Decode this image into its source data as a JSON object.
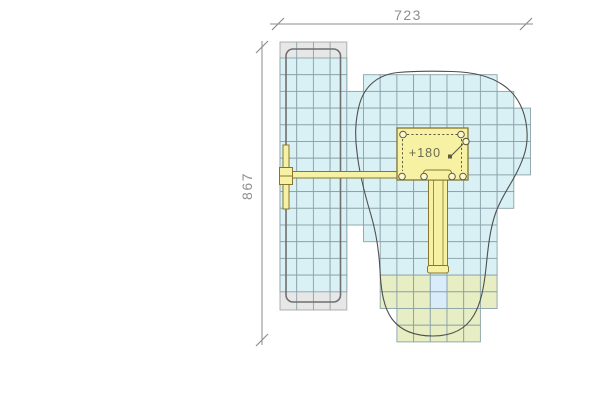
{
  "drawing": {
    "background": "#ffffff",
    "colors": {
      "tile_cyan": "#d9f1f4",
      "tile_green": "#e7eec3",
      "tile_landing": "#d9ecf9",
      "tile_stroke": "#8aa2a9",
      "mat_gray": "#e7e7e7",
      "mat_stroke": "#a8a8a8",
      "mat_inner_outline": "#6f6f6f",
      "zone_outline": "#4f4f4f",
      "equip_fill": "#f7f1a3",
      "equip_fill_light": "#fbf7cf",
      "equip_stroke": "#857634",
      "detail_stroke": "#5c5c44",
      "dim_color": "#8e8e8e",
      "label_color": "#6a6a52"
    },
    "grid": {
      "origin_x": 280,
      "origin_y": 58,
      "cell": 16.7
    },
    "dimensions": {
      "top": {
        "label": "723",
        "line": {
          "x1": 270,
          "x2": 533,
          "y": 24
        },
        "ticks": [
          278,
          526
        ],
        "label_pos": {
          "x": 408,
          "y": 20
        }
      },
      "left": {
        "label": "867",
        "line": {
          "y1": 41,
          "y2": 345,
          "x": 262
        },
        "ticks": [
          47,
          340
        ],
        "label_pos": {
          "x": 252,
          "y": 186
        }
      }
    },
    "mat_strip": {
      "x": 280,
      "y": 42,
      "w": 66.8,
      "h": 268,
      "inner": {
        "x": 286,
        "y": 49,
        "w": 54.5,
        "h": 253,
        "r": 7
      },
      "cyan": {
        "row0": 0,
        "row1": 13,
        "col0": 0,
        "col1": 3
      }
    },
    "tiles": {
      "cyan_rows": [
        {
          "row": 1,
          "c0": 5,
          "c1": 12
        },
        {
          "row": 2,
          "c0": 4,
          "c1": 13
        },
        {
          "row": 3,
          "c0": 4,
          "c1": 14
        },
        {
          "row": 4,
          "c0": 4,
          "c1": 14
        },
        {
          "row": 5,
          "c0": 4,
          "c1": 14
        },
        {
          "row": 6,
          "c0": 4,
          "c1": 14
        },
        {
          "row": 7,
          "c0": 4,
          "c1": 13
        },
        {
          "row": 8,
          "c0": 4,
          "c1": 13
        },
        {
          "row": 9,
          "c0": 4,
          "c1": 12
        },
        {
          "row": 10,
          "c0": 5,
          "c1": 12
        },
        {
          "row": 11,
          "c0": 6,
          "c1": 12
        },
        {
          "row": 12,
          "c0": 6,
          "c1": 12
        }
      ],
      "green_rows": [
        {
          "row": 13,
          "c0": 6,
          "c1": 12,
          "skip": [
            9
          ]
        },
        {
          "row": 14,
          "c0": 6,
          "c1": 12,
          "skip": [
            9
          ]
        },
        {
          "row": 15,
          "c0": 7,
          "c1": 11,
          "skip": []
        },
        {
          "row": 16,
          "c0": 7,
          "c1": 11,
          "skip": []
        }
      ],
      "landing_cells": [
        {
          "row": 13,
          "col": 9
        },
        {
          "row": 14,
          "col": 9
        }
      ]
    },
    "safety_zone_path": "M 398,72.5 C 378,74.5 364,86 359,106 C 355,122 355,138 357,152 C 359,172 365,195 371,215 C 376,232 379,252 380,270 C 381,292 384,308 392,319 C 401,331 415,336 433,336 C 452,336 466,329 474,315 C 481,303 484,287 486,268 C 488,248 490,228 496,212 C 502,196 510,186 517,172 C 524,158 528,146 527,132 C 526,112 518,95 503,85 C 490,76 472,72 452,71.5 C 433,71 414,71 398,72.5 Z",
    "equipment": {
      "beam": {
        "x": 289,
        "y": 171.5,
        "w": 108,
        "h": 6.5
      },
      "post_bar": {
        "x": 283,
        "y": 145,
        "w": 6,
        "h": 64
      },
      "nodes": [
        [
          279.5,
          167.5,
          13,
          8.5
        ],
        [
          279.5,
          176,
          13,
          8.5
        ]
      ],
      "platform": {
        "x": 397,
        "y": 128,
        "w": 71,
        "h": 52,
        "label": "+180",
        "label_pos": {
          "x": 425,
          "y": 157
        }
      },
      "dashes": [
        [
          407,
          134.5,
          458,
          134.5
        ],
        [
          402.5,
          139,
          402.5,
          171
        ],
        [
          461.5,
          139,
          461.5,
          171
        ]
      ],
      "posts": [
        [
          403,
          134.5
        ],
        [
          461,
          134.5
        ],
        [
          402,
          176.5
        ],
        [
          424,
          176.5
        ],
        [
          452,
          176.5
        ],
        [
          463,
          176.5
        ]
      ],
      "pole": {
        "x1": 450,
        "y1": 157,
        "x2": 463,
        "y2": 144,
        "cx": 466,
        "cy": 141.5,
        "r": 3.2,
        "anchor": [
          448,
          154.5,
          4,
          4
        ]
      },
      "entrance": {
        "x": 423.5,
        "y": 170,
        "w": 28,
        "h": 10,
        "r": 3
      },
      "slide": {
        "x": 428.5,
        "y": 180,
        "w": 19,
        "h": 88,
        "rail1": 433.5,
        "rail2": 443,
        "cap": {
          "x": 427.5,
          "y": 265.5,
          "w": 21,
          "h": 7.5,
          "r": 2
        }
      }
    }
  }
}
